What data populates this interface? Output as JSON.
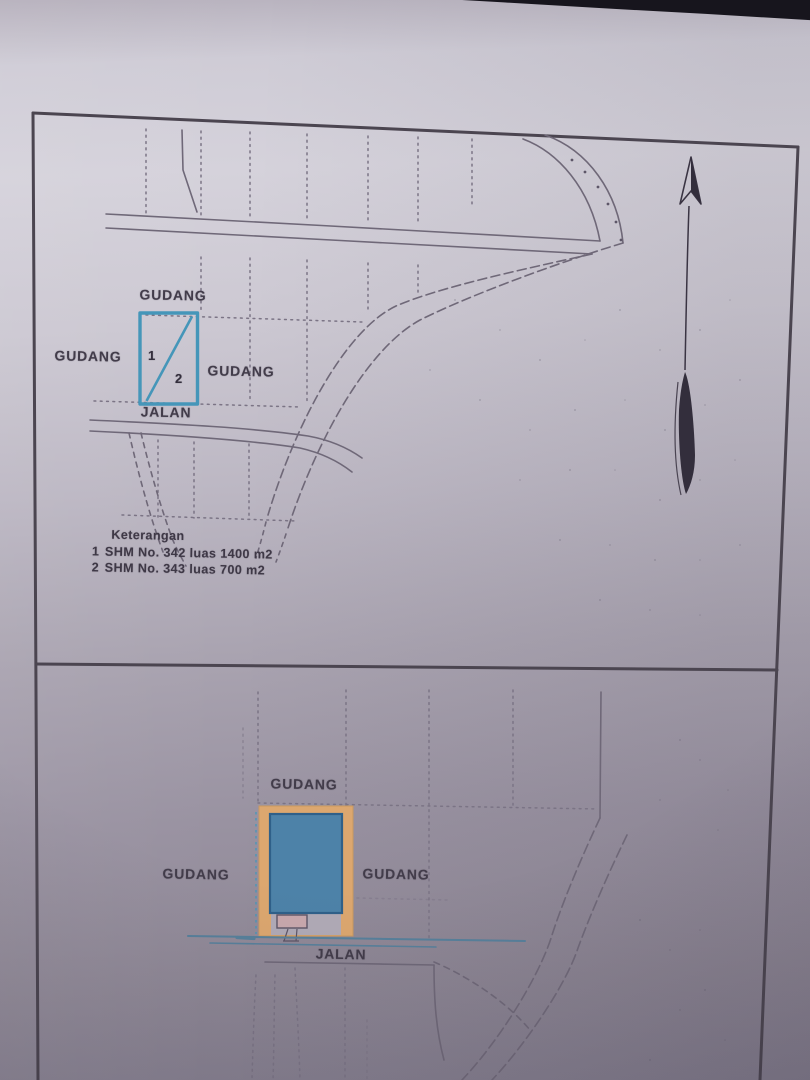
{
  "document": {
    "panels": {
      "top_map": {
        "labels": {
          "gudang_top": "GUDANG",
          "gudang_left": "GUDANG",
          "gudang_right": "GUDANG",
          "jalan": "JALAN"
        },
        "parcels": [
          {
            "number": "1"
          },
          {
            "number": "2"
          }
        ]
      },
      "bottom_map": {
        "labels": {
          "gudang_top": "GUDANG",
          "gudang_left": "GUDANG",
          "gudang_right": "GUDANG",
          "jalan": "JALAN"
        }
      }
    },
    "legend": {
      "title": "Keterangan",
      "items": [
        {
          "num": "1",
          "text": "SHM No. 342 luas 1400 m2"
        },
        {
          "num": "2",
          "text": "SHM No. 343 luas 700 m2"
        }
      ]
    },
    "colors": {
      "parcel_outline_blue": "#4596b9",
      "building_fill": "#4d82a8",
      "building_stroke": "#2f6089",
      "plot_fill_orange": "#dca76f",
      "plot_stroke_orange": "#c9995f",
      "annex_fill_pink": "#c8a8ad",
      "annex_stroke": "#5d5566",
      "road_blue": "#57809b",
      "ink": "#6f6878",
      "frame": "#4b4550",
      "arrow_dark": "#332e3c"
    }
  }
}
